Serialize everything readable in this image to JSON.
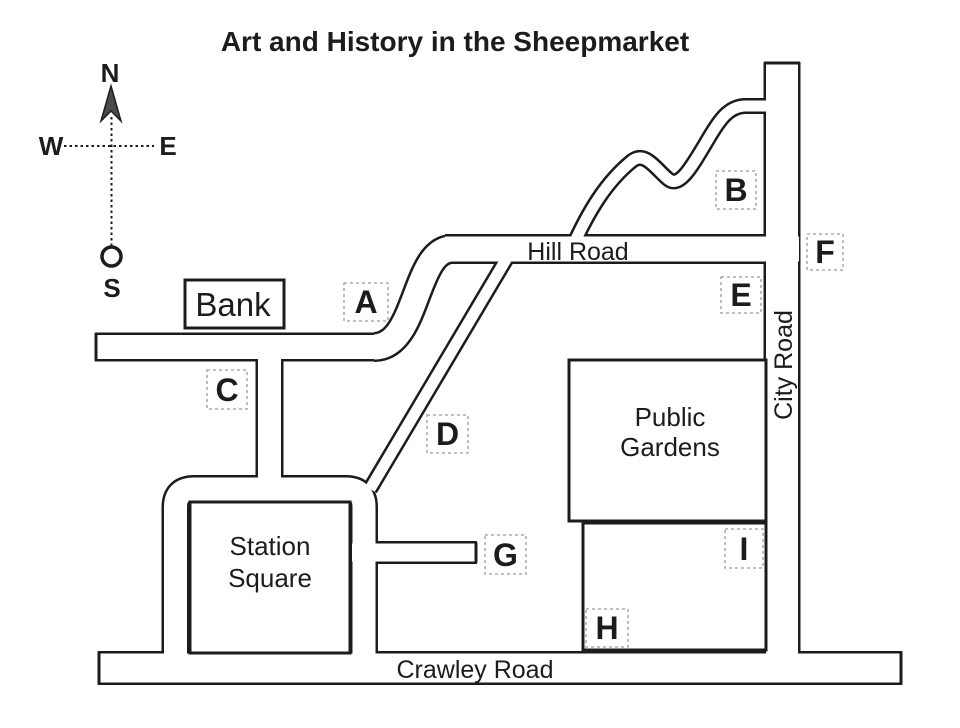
{
  "title": "Art and History in the Sheepmarket",
  "colors": {
    "ink": "#1c1c1c",
    "road_fill": "#ffffff",
    "marker_box_dash": "#9a9a9a",
    "background": "#ffffff",
    "compass_arrow": "#4a4a4a"
  },
  "compass": {
    "north": "N",
    "east": "E",
    "south": "S",
    "west": "W"
  },
  "roads": {
    "hill": "Hill Road",
    "city": "City Road",
    "crawley": "Crawley Road"
  },
  "places": {
    "bank": "Bank",
    "station_square": {
      "line1": "Station",
      "line2": "Square"
    },
    "public_gardens": {
      "line1": "Public",
      "line2": "Gardens"
    }
  },
  "markers": [
    "A",
    "B",
    "C",
    "D",
    "E",
    "F",
    "G",
    "H",
    "I"
  ]
}
